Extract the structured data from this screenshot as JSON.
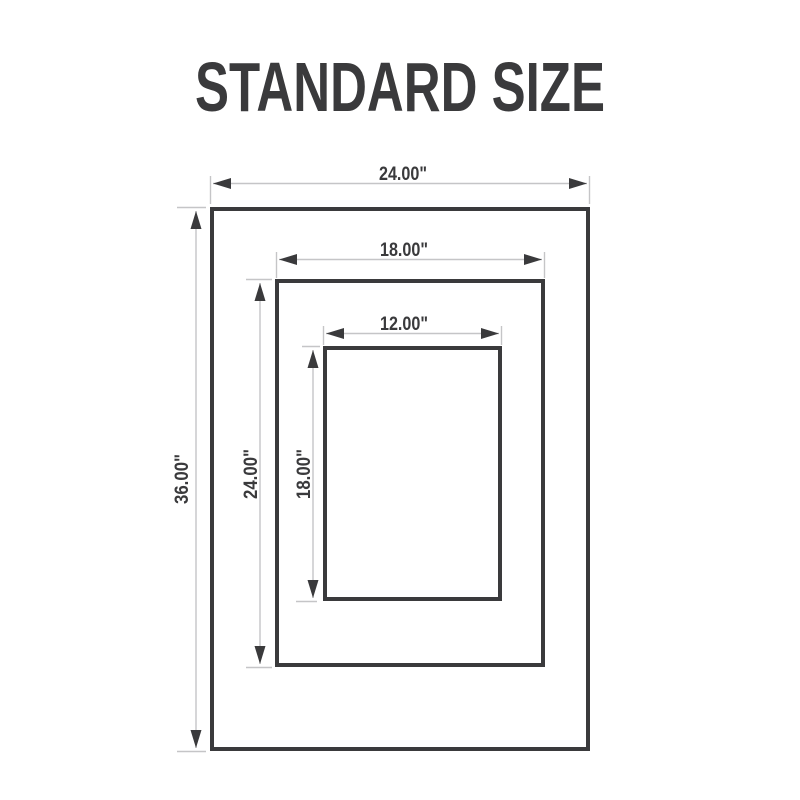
{
  "title": "STANDARD SIZE",
  "colors": {
    "bg": "#ffffff",
    "dark": "#3a3a3c",
    "light": "#c5c5c7"
  },
  "diagram": {
    "sizes": [
      {
        "id": "outer",
        "width_label": "24.00\"",
        "height_label": "36.00\""
      },
      {
        "id": "middle",
        "width_label": "18.00\"",
        "height_label": "24.00\""
      },
      {
        "id": "inner",
        "width_label": "12.00\"",
        "height_label": "18.00\""
      }
    ]
  }
}
